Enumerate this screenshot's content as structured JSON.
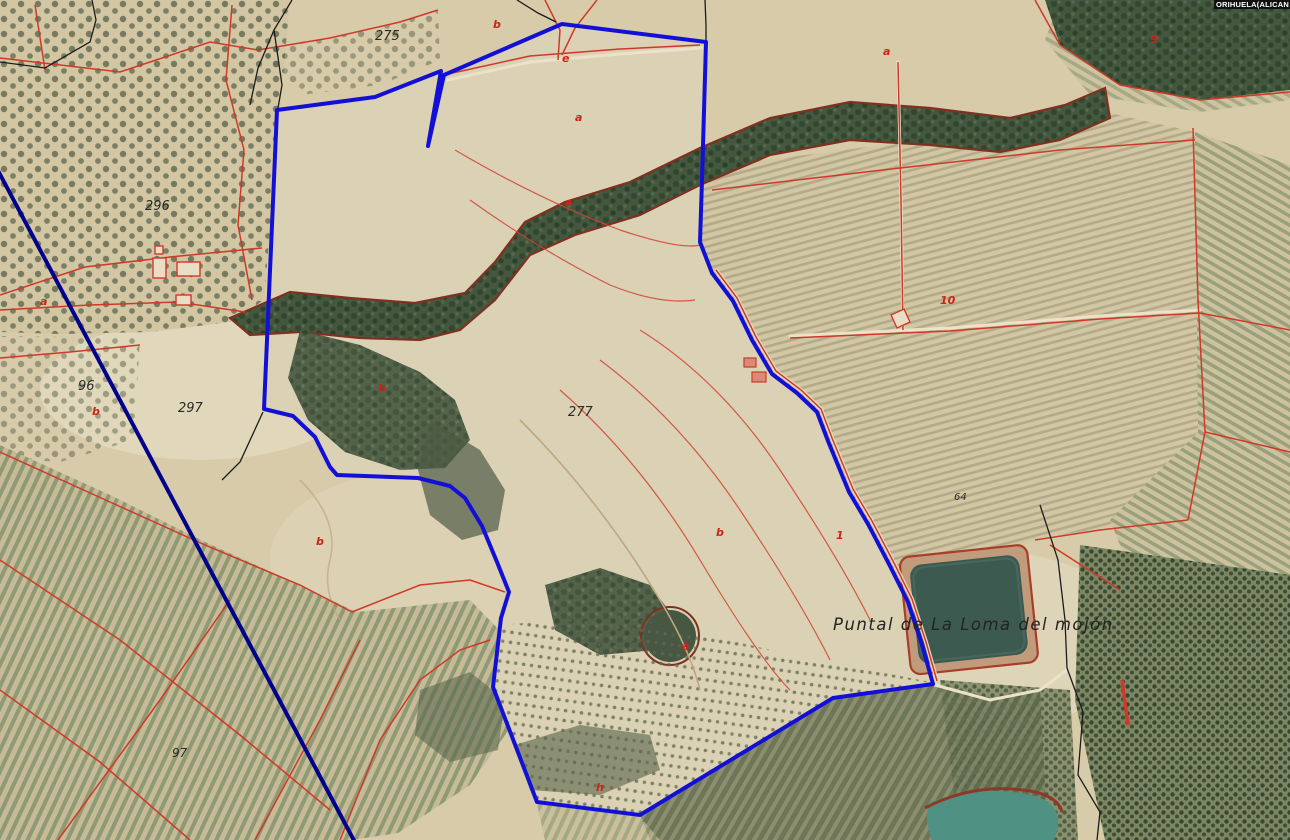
{
  "map": {
    "region_label": "ORIHUELA(ALICAN",
    "place_label": "Puntal  de La Loma del mojón",
    "parcel_numbers": [
      {
        "text": "275",
        "x": 375,
        "y": 40,
        "size": 13
      },
      {
        "text": "296",
        "x": 145,
        "y": 210,
        "size": 13
      },
      {
        "text": "96",
        "x": 78,
        "y": 390,
        "size": 13
      },
      {
        "text": "297",
        "x": 178,
        "y": 412,
        "size": 13
      },
      {
        "text": "277",
        "x": 568,
        "y": 416,
        "size": 13
      },
      {
        "text": "64",
        "x": 954,
        "y": 500,
        "size": 10
      },
      {
        "text": "97",
        "x": 172,
        "y": 757,
        "size": 12
      }
    ],
    "subparcel_letters": [
      {
        "text": "b",
        "x": 493,
        "y": 28
      },
      {
        "text": "e",
        "x": 562,
        "y": 62
      },
      {
        "text": "a",
        "x": 575,
        "y": 121
      },
      {
        "text": "a",
        "x": 565,
        "y": 206
      },
      {
        "text": "b",
        "x": 378,
        "y": 392
      },
      {
        "text": "b",
        "x": 316,
        "y": 545
      },
      {
        "text": "a",
        "x": 40,
        "y": 305
      },
      {
        "text": "b",
        "x": 92,
        "y": 415
      },
      {
        "text": "h",
        "x": 596,
        "y": 791
      },
      {
        "text": "b",
        "x": 716,
        "y": 536
      },
      {
        "text": "a",
        "x": 682,
        "y": 650
      },
      {
        "text": "a",
        "x": 883,
        "y": 55
      },
      {
        "text": "10",
        "x": 940,
        "y": 304
      },
      {
        "text": "9",
        "x": 1150,
        "y": 43
      },
      {
        "text": "1",
        "x": 836,
        "y": 539
      }
    ],
    "parcel_outline_points": "277,110 375,97 441,71 428,146 444,75 562,24 706,42 702,180 700,242 712,273 733,301 752,340 772,374 797,393 817,412 828,441 849,492 868,524 890,566 908,602 922,645 933,684 833,698 640,815 537,802 493,687 501,618 509,592 497,562 482,526 465,498 450,486 418,478 337,475 330,467 315,437 293,416 264,409",
    "colors": {
      "parcel_outline": "#1310d6",
      "municipal_line": "#00008a",
      "cadastral_line": "#cf3929",
      "ravine_edge": "#7e3120",
      "reservoir_water": "#3d5a51",
      "pond_water": "#4f9182",
      "label_text": "#2a2a26"
    }
  }
}
